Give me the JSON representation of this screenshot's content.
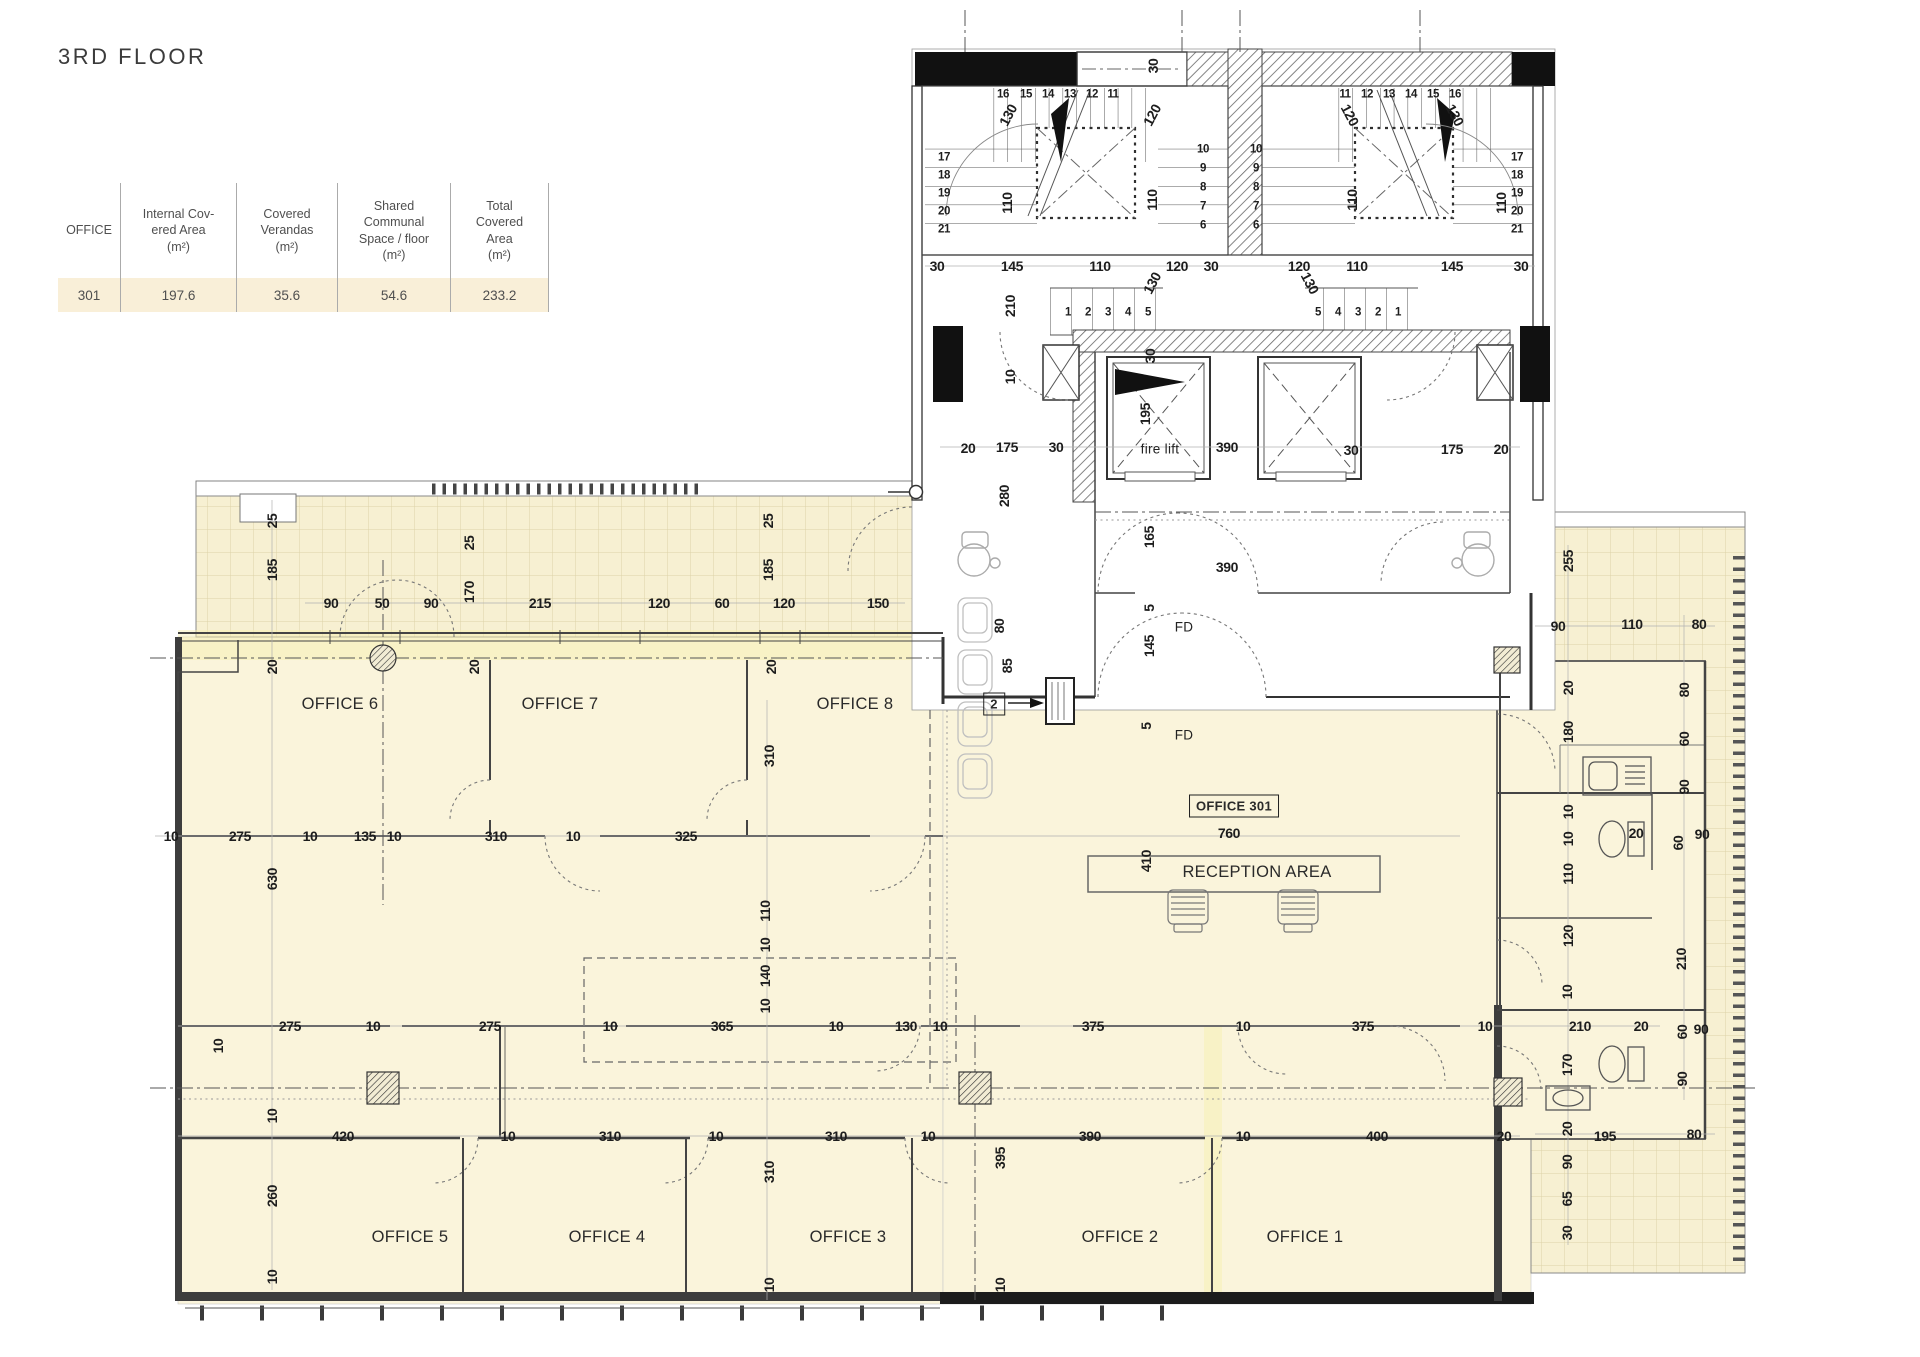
{
  "title": "3RD FLOOR",
  "table": {
    "headers": [
      "OFFICE",
      "Internal Cov-\nered Area\n(m²)",
      "Covered\nVerandas\n(m²)",
      "Shared\nCommunal\nSpace / floor\n(m²)",
      "Total\nCovered\nArea\n(m²)"
    ],
    "rows": [
      [
        "301",
        "197.6",
        "35.6",
        "54.6",
        "233.2"
      ]
    ]
  },
  "colors": {
    "floor": "#faf4db",
    "veranda_tile": "#f7f0d2",
    "highlight_row": "#f9efd8",
    "wall": "#3d3d3d",
    "highlight_band": "#f6f0ae"
  },
  "plan": {
    "rooms": [
      {
        "t": "OFFICE 6",
        "x": 340,
        "y": 704
      },
      {
        "t": "OFFICE 7",
        "x": 560,
        "y": 704
      },
      {
        "t": "OFFICE 8",
        "x": 855,
        "y": 704
      },
      {
        "t": "OFFICE 5",
        "x": 410,
        "y": 1237
      },
      {
        "t": "OFFICE 4",
        "x": 607,
        "y": 1237
      },
      {
        "t": "OFFICE 3",
        "x": 848,
        "y": 1237
      },
      {
        "t": "OFFICE 2",
        "x": 1120,
        "y": 1237
      },
      {
        "t": "OFFICE 1",
        "x": 1305,
        "y": 1237
      },
      {
        "t": "RECEPTION AREA",
        "x": 1257,
        "y": 872
      },
      {
        "t": "fire lift",
        "x": 1160,
        "y": 449,
        "k": "small"
      },
      {
        "t": "FD",
        "x": 1184,
        "y": 627,
        "k": "small"
      },
      {
        "t": "FD",
        "x": 1184,
        "y": 735,
        "k": "small"
      },
      {
        "t": "OFFICE 301",
        "x": 1234,
        "y": 806,
        "k": "boxed"
      },
      {
        "t": "2",
        "x": 994,
        "y": 704,
        "k": "boxed"
      }
    ],
    "dims": [
      [
        "16",
        1003,
        95,
        0,
        1
      ],
      [
        "15",
        1026,
        95,
        0,
        1
      ],
      [
        "14",
        1048,
        95,
        0,
        1
      ],
      [
        "13",
        1070,
        95,
        0,
        1
      ],
      [
        "12",
        1092,
        95,
        0,
        1
      ],
      [
        "11",
        1113,
        95,
        0,
        1
      ],
      [
        "11",
        1345,
        95,
        0,
        1
      ],
      [
        "12",
        1367,
        95,
        0,
        1
      ],
      [
        "13",
        1389,
        95,
        0,
        1
      ],
      [
        "14",
        1411,
        95,
        0,
        1
      ],
      [
        "15",
        1433,
        95,
        0,
        1
      ],
      [
        "16",
        1455,
        95,
        0,
        1
      ],
      [
        "17",
        944,
        158,
        0,
        1
      ],
      [
        "18",
        944,
        176,
        0,
        1
      ],
      [
        "19",
        944,
        194,
        0,
        1
      ],
      [
        "20",
        944,
        212,
        0,
        1
      ],
      [
        "21",
        944,
        230,
        0,
        1
      ],
      [
        "10",
        1203,
        150,
        0,
        1
      ],
      [
        "9",
        1203,
        169,
        0,
        1
      ],
      [
        "8",
        1203,
        188,
        0,
        1
      ],
      [
        "7",
        1203,
        207,
        0,
        1
      ],
      [
        "6",
        1203,
        226,
        0,
        1
      ],
      [
        "10",
        1256,
        150,
        0,
        1
      ],
      [
        "9",
        1256,
        169,
        0,
        1
      ],
      [
        "8",
        1256,
        188,
        0,
        1
      ],
      [
        "7",
        1256,
        207,
        0,
        1
      ],
      [
        "6",
        1256,
        226,
        0,
        1
      ],
      [
        "17",
        1517,
        158,
        0,
        1
      ],
      [
        "18",
        1517,
        176,
        0,
        1
      ],
      [
        "19",
        1517,
        194,
        0,
        1
      ],
      [
        "20",
        1517,
        212,
        0,
        1
      ],
      [
        "21",
        1517,
        230,
        0,
        1
      ],
      [
        "1",
        1068,
        313,
        0,
        1
      ],
      [
        "2",
        1088,
        313,
        0,
        1
      ],
      [
        "3",
        1108,
        313,
        0,
        1
      ],
      [
        "4",
        1128,
        313,
        0,
        1
      ],
      [
        "5",
        1148,
        313,
        0,
        1
      ],
      [
        "5",
        1318,
        313,
        0,
        1
      ],
      [
        "4",
        1338,
        313,
        0,
        1
      ],
      [
        "3",
        1358,
        313,
        0,
        1
      ],
      [
        "2",
        1378,
        313,
        0,
        1
      ],
      [
        "1",
        1398,
        313,
        0,
        1
      ],
      [
        "130",
        1008,
        115,
        -62
      ],
      [
        "120",
        1152,
        115,
        -62
      ],
      [
        "120",
        1350,
        115,
        62
      ],
      [
        "130",
        1455,
        115,
        62
      ],
      [
        "110",
        1007,
        203,
        -90
      ],
      [
        "110",
        1152,
        200,
        -90
      ],
      [
        "110",
        1352,
        200,
        -90
      ],
      [
        "110",
        1501,
        203,
        -90
      ],
      [
        "30",
        1153,
        66,
        -90
      ],
      [
        "30",
        937,
        266
      ],
      [
        "145",
        1012,
        266
      ],
      [
        "110",
        1100,
        266
      ],
      [
        "120",
        1177,
        266
      ],
      [
        "30",
        1211,
        266
      ],
      [
        "120",
        1299,
        266
      ],
      [
        "110",
        1357,
        266
      ],
      [
        "145",
        1452,
        266
      ],
      [
        "30",
        1521,
        266
      ],
      [
        "210",
        1010,
        306,
        -90
      ],
      [
        "130",
        1152,
        283,
        -62
      ],
      [
        "130",
        1310,
        283,
        62
      ],
      [
        "30",
        1150,
        356,
        -90
      ],
      [
        "10",
        1010,
        377,
        -90
      ],
      [
        "20",
        968,
        448
      ],
      [
        "175",
        1007,
        447
      ],
      [
        "30",
        1056,
        447
      ],
      [
        "195",
        1145,
        414,
        -90
      ],
      [
        "390",
        1227,
        447
      ],
      [
        "30",
        1351,
        450
      ],
      [
        "175",
        1452,
        449
      ],
      [
        "20",
        1501,
        449
      ],
      [
        "280",
        1004,
        496,
        -90
      ],
      [
        "165",
        1149,
        537,
        -90
      ],
      [
        "390",
        1227,
        567
      ],
      [
        "80",
        999,
        626,
        -90
      ],
      [
        "85",
        1007,
        666,
        -90
      ],
      [
        "5",
        1149,
        608,
        -90
      ],
      [
        "145",
        1149,
        646,
        -90
      ],
      [
        "5",
        1146,
        726,
        -90
      ],
      [
        "410",
        1146,
        861,
        -90
      ],
      [
        "760",
        1229,
        833
      ],
      [
        "25",
        272,
        521,
        -90
      ],
      [
        "185",
        272,
        570,
        -90
      ],
      [
        "25",
        469,
        543,
        -90
      ],
      [
        "170",
        469,
        592,
        -90
      ],
      [
        "25",
        768,
        521,
        -90
      ],
      [
        "185",
        768,
        570,
        -90
      ],
      [
        "90",
        331,
        603
      ],
      [
        "50",
        382,
        603
      ],
      [
        "90",
        431,
        603
      ],
      [
        "215",
        540,
        603
      ],
      [
        "120",
        659,
        603
      ],
      [
        "60",
        722,
        603
      ],
      [
        "120",
        784,
        603
      ],
      [
        "150",
        878,
        603
      ],
      [
        "20",
        272,
        667,
        -90
      ],
      [
        "20",
        474,
        667,
        -90
      ],
      [
        "20",
        771,
        667,
        -90
      ],
      [
        "255",
        1568,
        561,
        -90
      ],
      [
        "90",
        1558,
        626
      ],
      [
        "110",
        1632,
        624
      ],
      [
        "80",
        1699,
        624
      ],
      [
        "20",
        1568,
        688,
        -90
      ],
      [
        "80",
        1684,
        690,
        -90
      ],
      [
        "180",
        1568,
        732,
        -90
      ],
      [
        "60",
        1684,
        739,
        -90
      ],
      [
        "90",
        1684,
        787,
        -90
      ],
      [
        "10",
        1568,
        812,
        -90
      ],
      [
        "10",
        1568,
        839,
        -90
      ],
      [
        "110",
        1568,
        874,
        -90
      ],
      [
        "20",
        1636,
        833
      ],
      [
        "60",
        1678,
        843,
        -90
      ],
      [
        "90",
        1702,
        834
      ],
      [
        "120",
        1568,
        936,
        -90
      ],
      [
        "210",
        1681,
        959,
        -90
      ],
      [
        "10",
        1567,
        992,
        -90
      ],
      [
        "60",
        1682,
        1032,
        -90
      ],
      [
        "90",
        1701,
        1029
      ],
      [
        "170",
        1567,
        1065,
        -90
      ],
      [
        "90",
        1682,
        1079,
        -90
      ],
      [
        "20",
        1567,
        1129,
        -90
      ],
      [
        "195",
        1605,
        1136
      ],
      [
        "80",
        1694,
        1134
      ],
      [
        "90",
        1567,
        1162,
        -90
      ],
      [
        "65",
        1567,
        1199,
        -90
      ],
      [
        "30",
        1567,
        1233,
        -90
      ],
      [
        "630",
        272,
        879,
        -90
      ],
      [
        "10",
        171,
        836
      ],
      [
        "275",
        240,
        836
      ],
      [
        "10",
        310,
        836
      ],
      [
        "135",
        365,
        836
      ],
      [
        "10",
        394,
        836
      ],
      [
        "310",
        496,
        836
      ],
      [
        "10",
        573,
        836
      ],
      [
        "325",
        686,
        836
      ],
      [
        "310",
        769,
        756,
        -90
      ],
      [
        "110",
        765,
        911,
        -90
      ],
      [
        "10",
        765,
        945,
        -90
      ],
      [
        "140",
        765,
        976,
        -90
      ],
      [
        "10",
        765,
        1006,
        -90
      ],
      [
        "10",
        218,
        1046,
        -90
      ],
      [
        "275",
        290,
        1026
      ],
      [
        "10",
        373,
        1026
      ],
      [
        "275",
        490,
        1026
      ],
      [
        "10",
        610,
        1026
      ],
      [
        "365",
        722,
        1026
      ],
      [
        "10",
        836,
        1026
      ],
      [
        "130",
        906,
        1026
      ],
      [
        "10",
        940,
        1026
      ],
      [
        "375",
        1093,
        1026
      ],
      [
        "10",
        1243,
        1026
      ],
      [
        "375",
        1363,
        1026
      ],
      [
        "10",
        1485,
        1026
      ],
      [
        "210",
        1580,
        1026
      ],
      [
        "20",
        1641,
        1026
      ],
      [
        "420",
        343,
        1136
      ],
      [
        "10",
        508,
        1136
      ],
      [
        "310",
        610,
        1136
      ],
      [
        "10",
        716,
        1136
      ],
      [
        "310",
        836,
        1136
      ],
      [
        "10",
        928,
        1136
      ],
      [
        "395",
        1000,
        1158,
        -90
      ],
      [
        "390",
        1090,
        1136
      ],
      [
        "10",
        1243,
        1136
      ],
      [
        "400",
        1377,
        1136
      ],
      [
        "20",
        1504,
        1136
      ],
      [
        "260",
        272,
        1196,
        -90
      ],
      [
        "10",
        272,
        1116,
        -90
      ],
      [
        "10",
        272,
        1277,
        -90
      ],
      [
        "310",
        769,
        1172,
        -90
      ],
      [
        "10",
        769,
        1285,
        -90
      ],
      [
        "10",
        1000,
        1285,
        -90
      ]
    ]
  }
}
